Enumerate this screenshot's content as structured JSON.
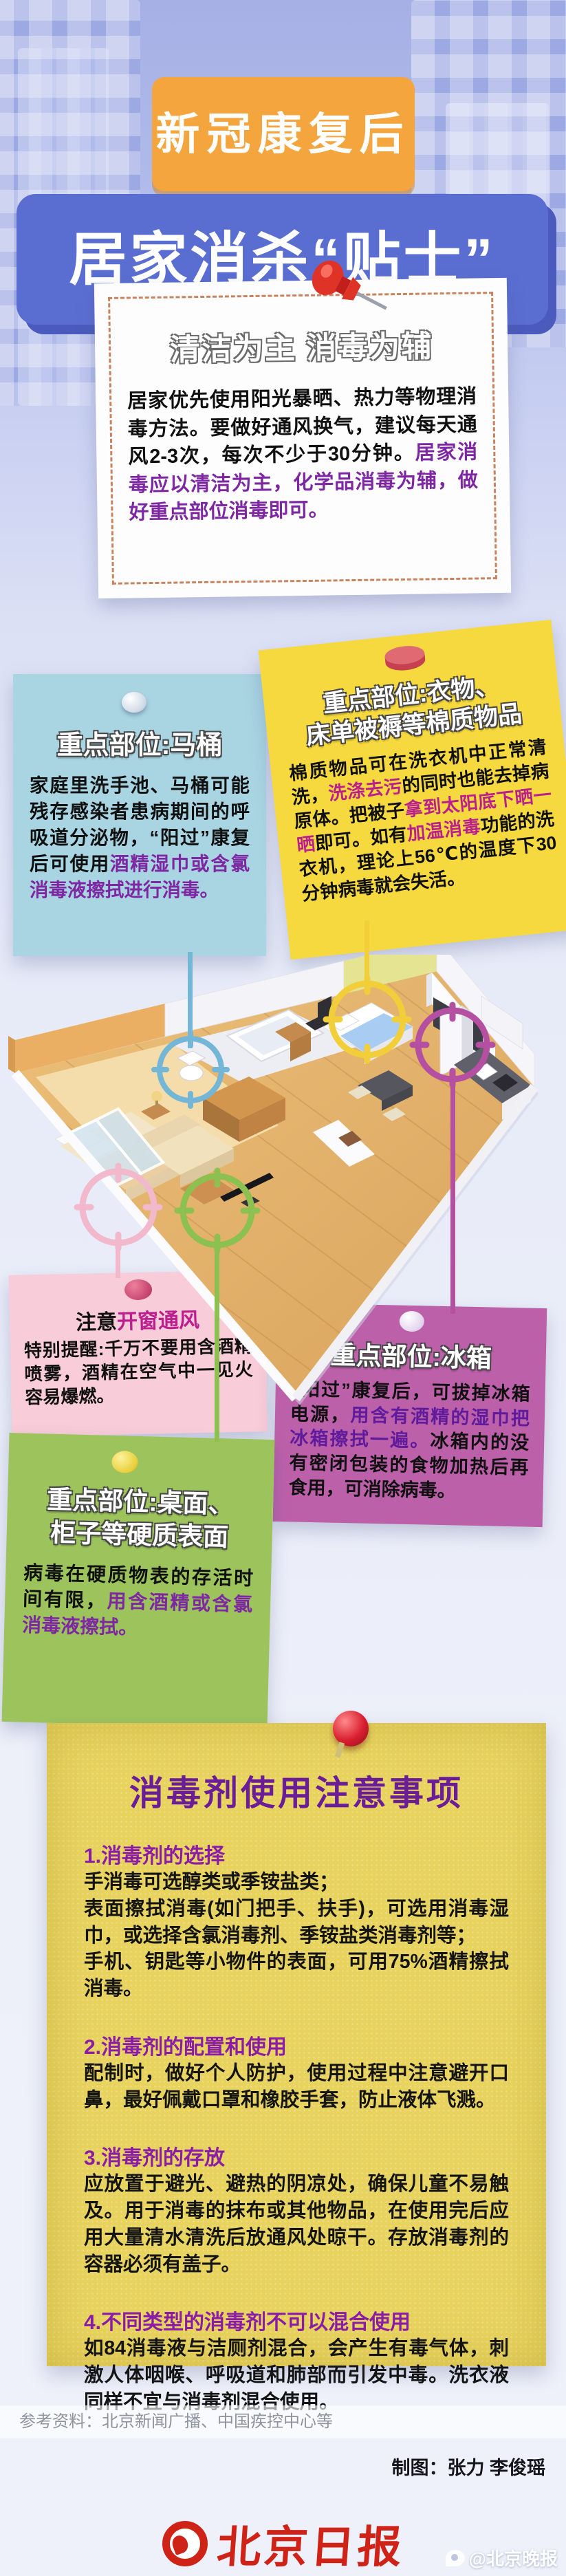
{
  "header": {
    "badge": "新冠康复后",
    "title": "居家消杀“贴士”"
  },
  "intro_card": {
    "title": "清洁为主  消毒为辅",
    "body": [
      {
        "t": "居家优先使用阳光暴晒、热力等物理消毒方法。要做好通风换气，建议每天通风2-3次，每次不少于30分钟。"
      },
      {
        "t": "居家消毒应以清洁为主，化学品消毒为辅，做好重点部位消毒即可。",
        "h": "purple"
      }
    ]
  },
  "toilet_card": {
    "title": "重点部位:马桶",
    "body": [
      {
        "t": "家庭里洗手池、马桶可能残存感染者患病期间的呼吸道分泌物，“阳过”康复后可使用"
      },
      {
        "t": "酒精湿巾或含氯消毒液擦拭进行消毒。",
        "h": "purple"
      }
    ]
  },
  "laundry_card": {
    "title": "重点部位:衣物、\n床单被褥等棉质物品",
    "body": [
      {
        "t": "棉质物品可在洗衣机中正常清洗，"
      },
      {
        "t": "洗涤去污",
        "h": "magenta"
      },
      {
        "t": "的同时也能去掉病原体。把被子"
      },
      {
        "t": "拿到太阳底下晒一晒",
        "h": "magenta"
      },
      {
        "t": "即可。如有"
      },
      {
        "t": "加温消毒",
        "h": "magenta"
      },
      {
        "t": "功能的洗衣机，理论上56℃的温度下30分钟病毒就会失活。"
      }
    ]
  },
  "window_card": {
    "title": [
      {
        "t": "注意"
      },
      {
        "t": "开窗通风",
        "h": "magenta"
      }
    ],
    "body": [
      {
        "t": "特别提醒:千万不要用含酒精喷雾，酒精在空气中一见火容易爆燃。"
      }
    ]
  },
  "fridge_card": {
    "title": "重点部位:冰箱",
    "body": [
      {
        "t": "“阳过”康复后，可拔掉冰箱电源，"
      },
      {
        "t": "用含有酒精的湿巾把冰箱擦拭一遍。",
        "h": "deep"
      },
      {
        "t": "冰箱内的没有密闭包装的食物加热后再食用，可消除病毒。"
      }
    ]
  },
  "surface_card": {
    "title": "重点部位:桌面、\n柜子等硬质表面",
    "body": [
      {
        "t": "病毒在硬质物表的存活时间有限，"
      },
      {
        "t": "用含酒精或含氯消毒液擦拭。",
        "h": "purple"
      }
    ]
  },
  "note": {
    "title": "消毒剂使用注意事项",
    "sections": [
      {
        "heading": "1.消毒剂的选择",
        "body": "手消毒可选醇类或季铵盐类；\n表面擦拭消毒(如门把手、扶手)，可选用消毒湿巾，或选择含氯消毒剂、季铵盐类消毒剂等；\n手机、钥匙等小物件的表面，可用75%酒精擦拭消毒。"
      },
      {
        "heading": "2.消毒剂的配置和使用",
        "body": "配制时，做好个人防护，使用过程中注意避开口鼻，最好佩戴口罩和橡胶手套，防止液体飞溅。"
      },
      {
        "heading": "3.消毒剂的存放",
        "body": "应放置于避光、避热的阴凉处，确保儿童不易触及。用于消毒的抹布或其他物品，在使用完后应用大量清水清洗后放通风处晾干。存放消毒剂的容器必须有盖子。"
      },
      {
        "heading": "4.不同类型的消毒剂不可以混合使用",
        "body": "如84消毒液与洁厕剂混合，会产生有毒气体，刺激人体咽喉、呼吸道和肺部而引发中毒。洗衣液同样不宜与消毒剂混合使用。"
      }
    ]
  },
  "footer": {
    "reference": "参考资料：北京新闻广播、中国疾控中心等",
    "credit": "制图：张力 李俊瑶",
    "logo": "北京日报",
    "watermark": "@北京晚报"
  },
  "icons": {
    "red-pushpin-icon": "red tilted pushpin on intro card",
    "white-pin-icon": "round white pin on toilet and fridge cards",
    "red-cylinder-pin-icon": "red cylinder magnet pin on laundry card",
    "pink-pin-icon": "dark pink round pin on window card",
    "yellow-pin-icon": "yellow round pin on surface card",
    "red-ballpin-icon": "red ball pin on disinfectant note",
    "toilet-marker-icon": "cyan crosshair circle on toilet",
    "bed-marker-icon": "yellow crosshair circle on bed",
    "fridge-marker-icon": "magenta crosshair circle on fridge",
    "window-marker-icon": "pink crosshair circle on balcony door",
    "table-marker-icon": "green crosshair circle on coffee table"
  },
  "colors": {
    "badge_orange": "#f5a53e",
    "title_blue": "#5a6ed2",
    "toilet_card": "#a9d4e2",
    "laundry_card": "#f6d93e",
    "window_card": "#f8ccd9",
    "fridge_card": "#bc60a9",
    "surface_card": "#9dc45c",
    "note_yellow": "#e7d35e",
    "highlight_purple": "#7e27a2",
    "highlight_magenta": "#bb1f8e",
    "logo_red": "#cf2318",
    "marker_cyan": "#74b6d6",
    "marker_yellow": "#f2cf3a",
    "marker_magenta": "#b44fa2",
    "marker_pink": "#f2b8cc",
    "marker_green": "#8cc152"
  }
}
